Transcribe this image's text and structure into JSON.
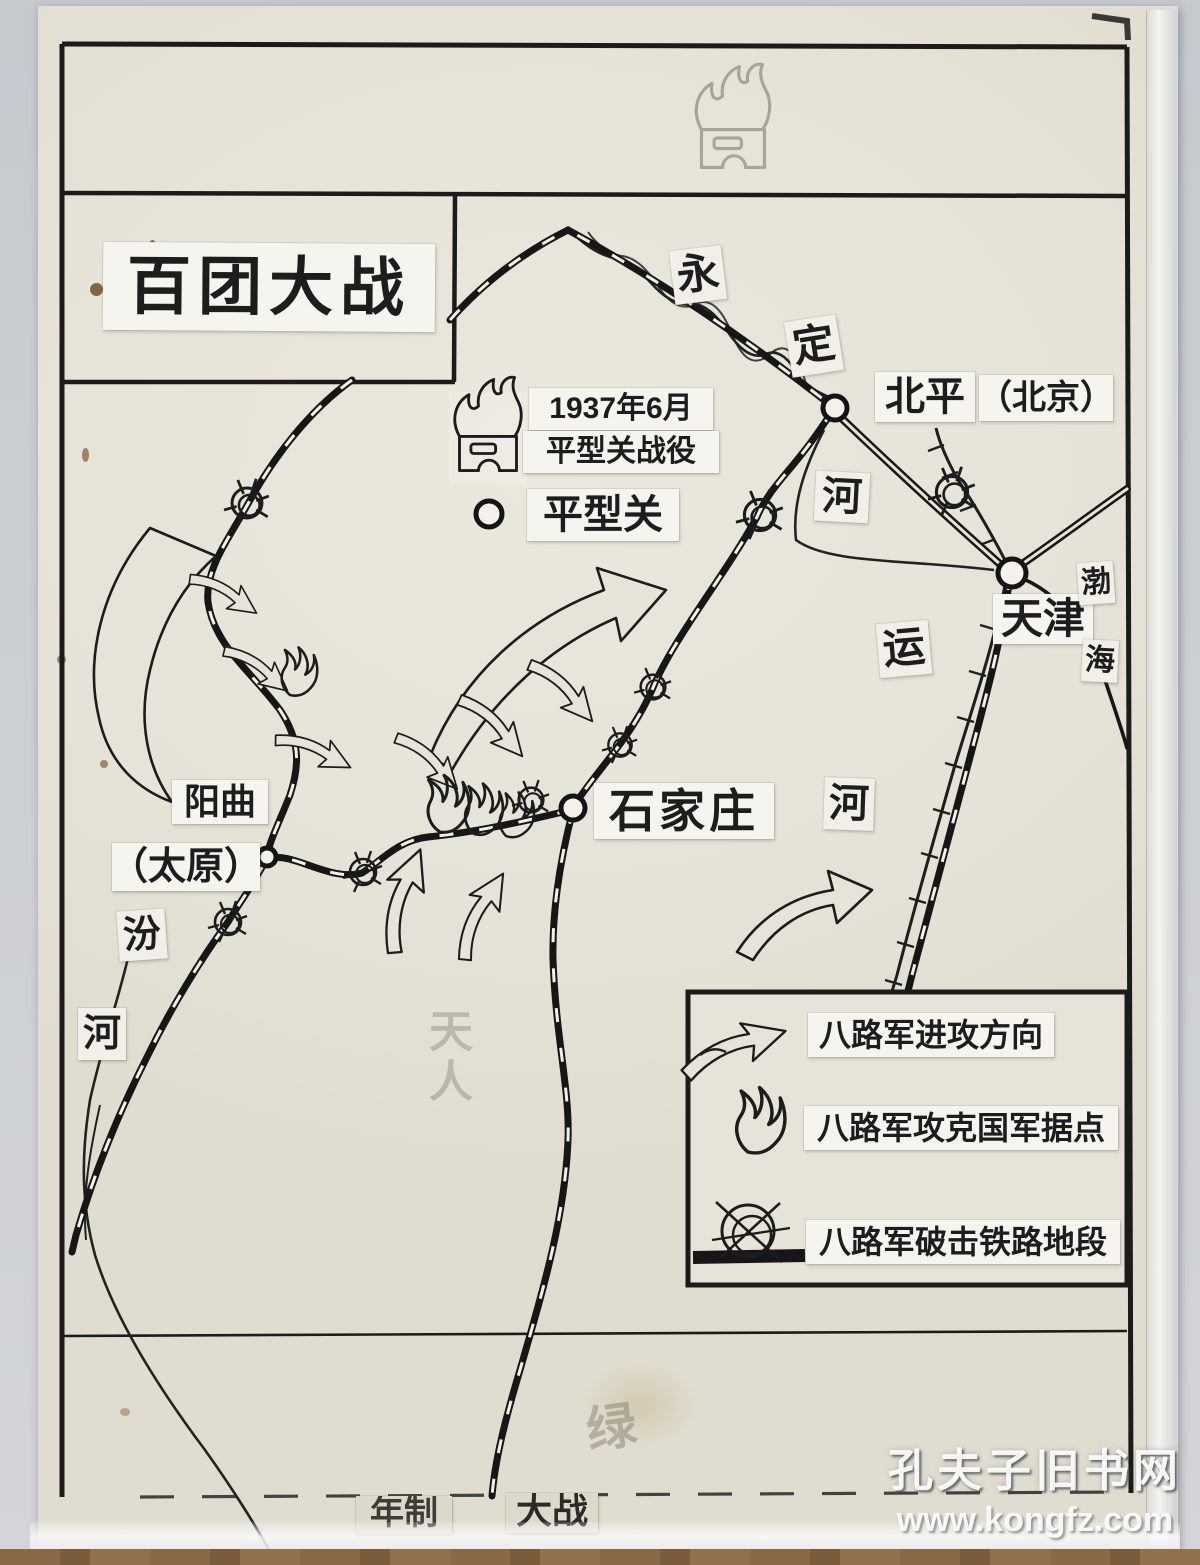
{
  "map": {
    "title": "百团大战",
    "battle_note": {
      "line1": "1937年6月",
      "line2": "平型关战役"
    },
    "places": {
      "pingxingguan": "平型关",
      "beiping": "北平",
      "beijing_paren": "（北京）",
      "tianjin": "天津",
      "shijiazhuang": "石家庄",
      "yangqu": "阳曲",
      "taiyuan_paren": "（太原）"
    },
    "waters": {
      "yongding": [
        "永",
        "定",
        "河"
      ],
      "grand_canal": [
        "运",
        "河"
      ],
      "fen_river": [
        "汾",
        "河"
      ],
      "bohai": [
        "渤",
        "海"
      ]
    },
    "legend": [
      {
        "symbol": "attack-arrow",
        "label": "八路军进攻方向"
      },
      {
        "symbol": "captured-stronghold-flame",
        "label": "八路军攻克国军据点"
      },
      {
        "symbol": "railway-sabotage",
        "label": "八路军破击铁路地段"
      }
    ],
    "bottom_strip": {
      "left": "年制",
      "right": "大战"
    },
    "pencil_marks": {
      "center_note": "天人",
      "lower_note": "绿"
    }
  },
  "watermark": {
    "line1": "孔夫子旧书网",
    "line2": "www.kongfz.com"
  },
  "colors": {
    "ink": "#1c1c1c",
    "paper": "#e6e3d8",
    "pencil": "#9b958a"
  }
}
